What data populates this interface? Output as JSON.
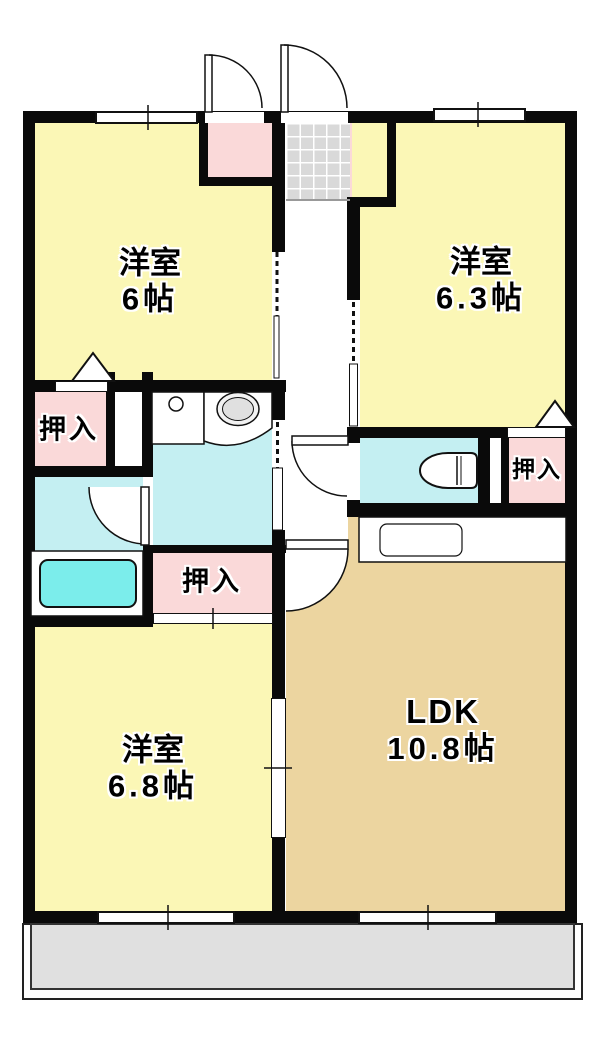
{
  "rooms": {
    "room_top_left": {
      "name": "洋室",
      "size": "6帖"
    },
    "room_top_right": {
      "name": "洋室",
      "size": "6.3帖"
    },
    "room_bottom_left": {
      "name": "洋室",
      "size": "6.8帖"
    },
    "ldk": {
      "name": "LDK",
      "size": "10.8帖"
    },
    "closet_left": {
      "name": "押入"
    },
    "closet_center": {
      "name": "押入"
    },
    "closet_right": {
      "name": "押入"
    }
  },
  "colors": {
    "room_yellow": "#fbf7b6",
    "ldk_tan": "#ecd5a0",
    "closet_pink": "#fad9d9",
    "wet_area_cyan": "#c4eff2",
    "bathtub_cyan": "#7bedeb",
    "entrance_tile_gray": "#d9d9d9",
    "balcony_gray": "#e0e0e0",
    "wall_black": "#0a0a0a"
  }
}
